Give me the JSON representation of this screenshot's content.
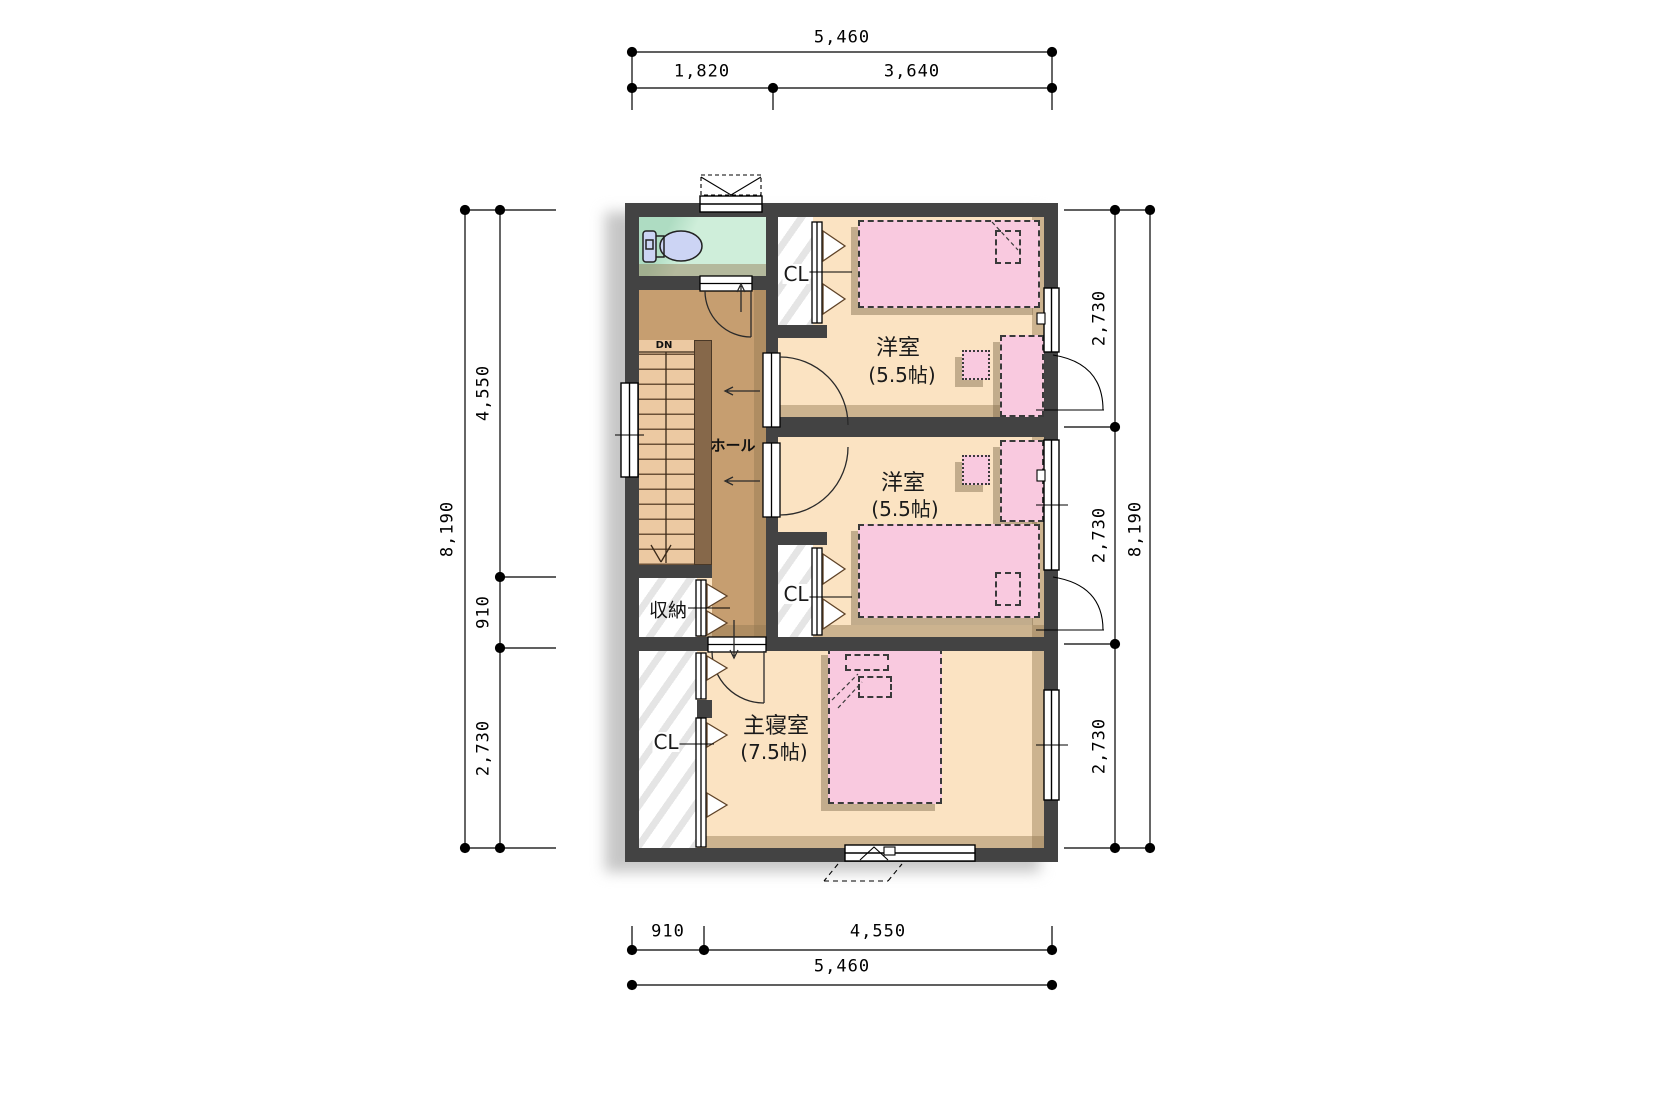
{
  "rooms": {
    "western1": {
      "name": "洋室",
      "size": "(5.5帖)"
    },
    "western2": {
      "name": "洋室",
      "size": "(5.5帖)"
    },
    "master_bedroom": {
      "name": "主寝室",
      "size": "(7.5帖)"
    },
    "hall": {
      "label": "ホール"
    },
    "storage": {
      "label": "収納"
    },
    "closet_west1": {
      "label": "CL"
    },
    "closet_west2": {
      "label": "CL"
    },
    "closet_master": {
      "label": "CL"
    },
    "stairs": {
      "down_label": "DN"
    }
  },
  "dimensions": {
    "top": {
      "total": "5,460",
      "seg1": "1,820",
      "seg2": "3,640"
    },
    "bottom": {
      "seg1": "910",
      "seg2": "4,550",
      "total": "5,460"
    },
    "left": {
      "total": "8,190",
      "seg1": "4,550",
      "seg2": "910",
      "seg3": "2,730"
    },
    "right": {
      "seg1": "2,730",
      "seg2": "2,730",
      "seg3": "2,730",
      "total": "8,190"
    }
  },
  "colors": {
    "wall": "#434343",
    "room_floor": "#fbe3c2",
    "hall_floor": "#c69e70",
    "stair_tread": "#ecc9a2",
    "stair_rail": "#86684a",
    "toilet_floor": "#cfeeda",
    "toilet_fixture": "#ccd4f4",
    "furniture_pink": "#f9c9df",
    "closet_white": "#ffffff",
    "dimension_line": "#000000",
    "plan_shadow": "#c6c6c6"
  }
}
